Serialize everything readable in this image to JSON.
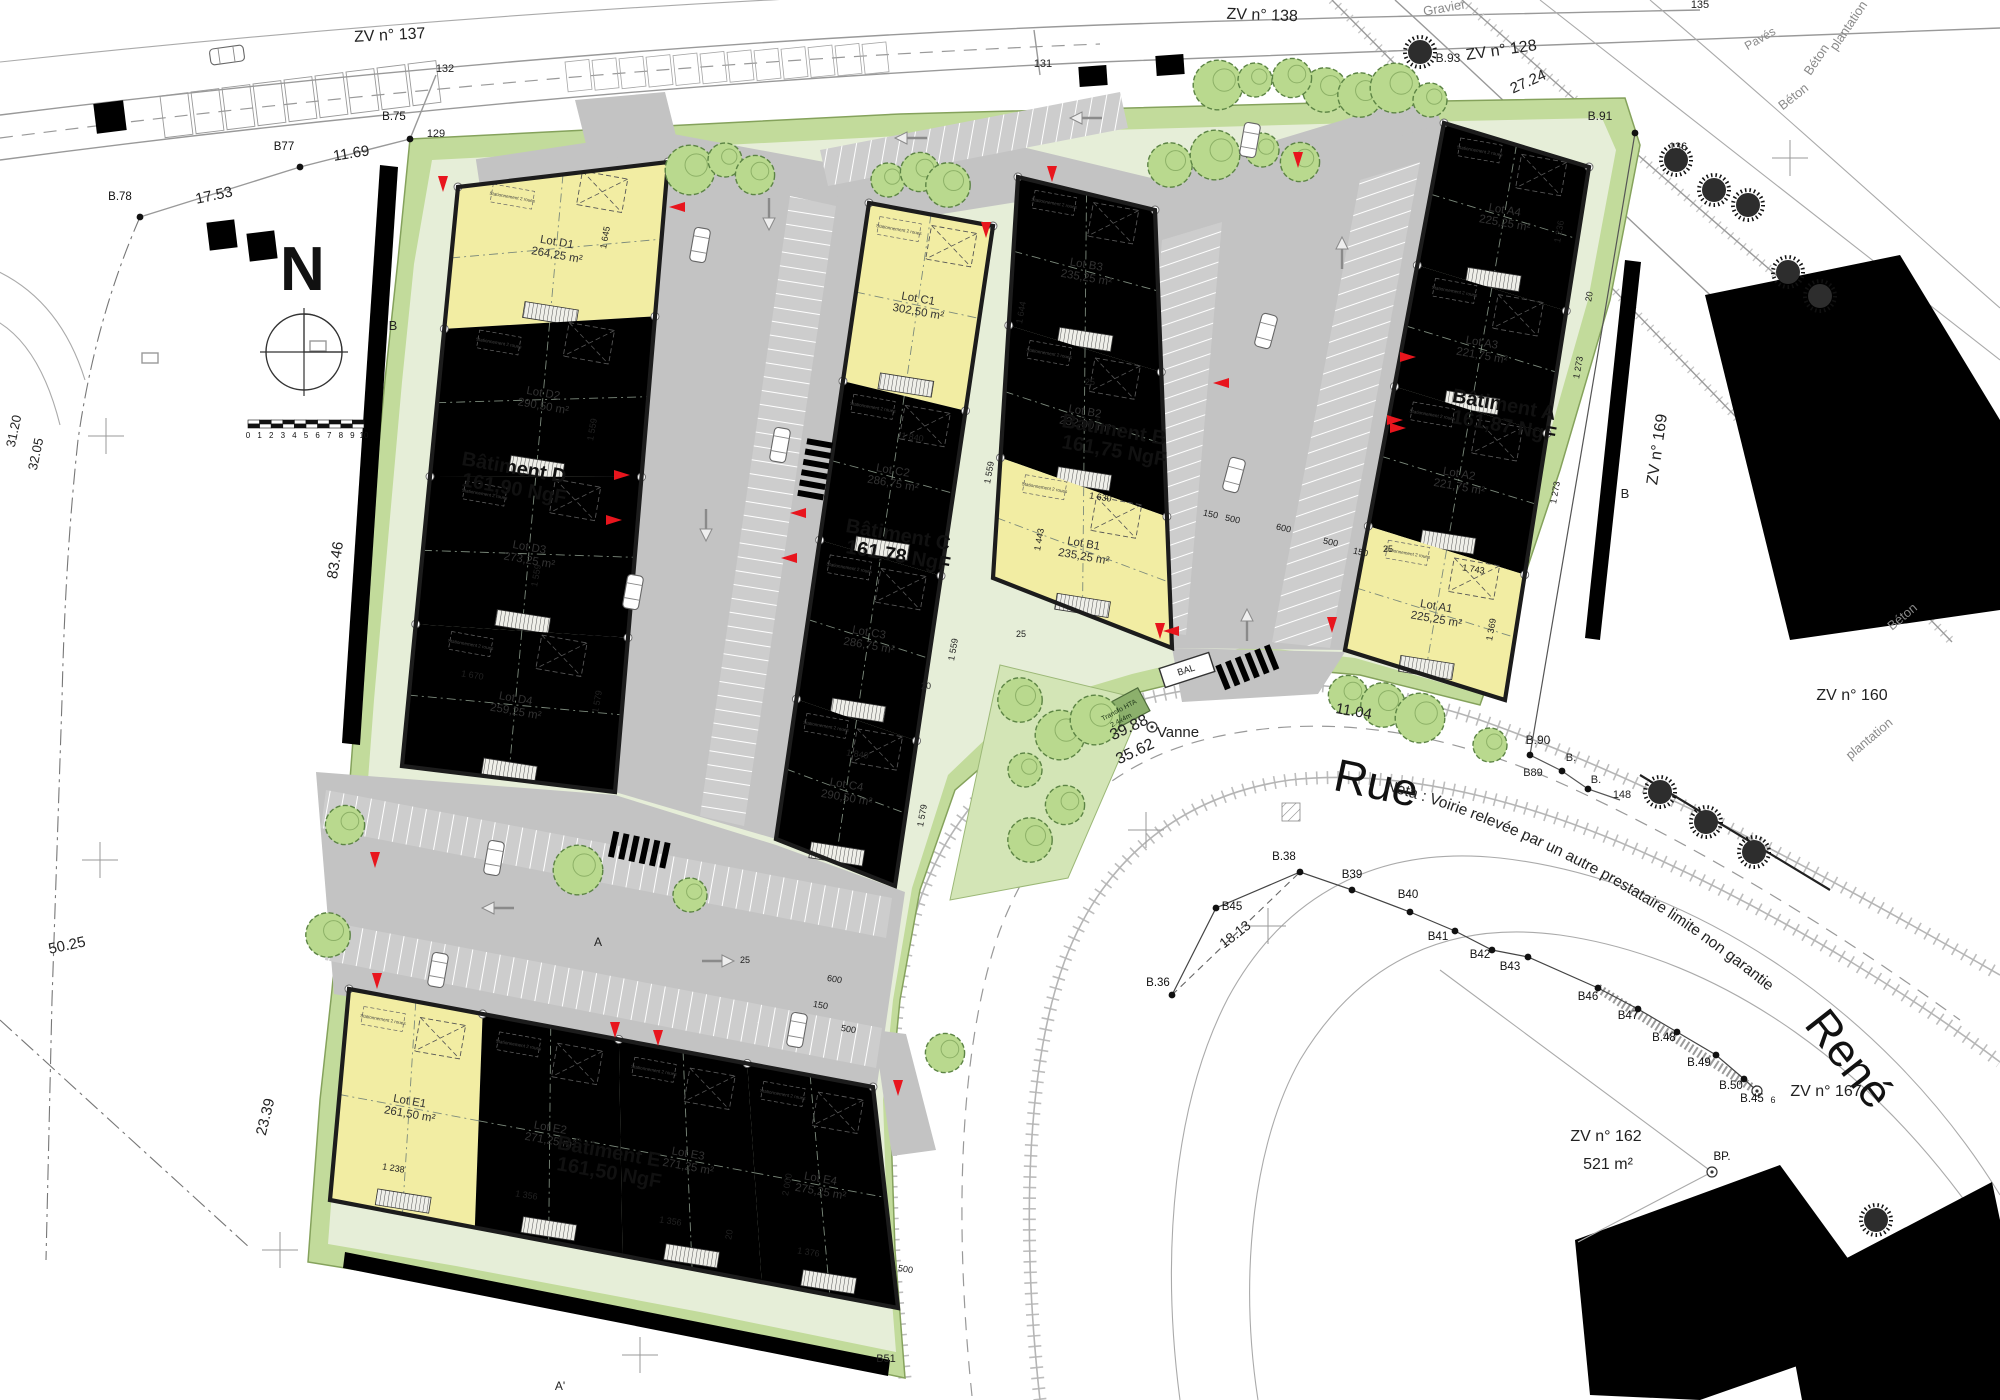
{
  "drawing": {
    "type": "plan de masse / site plan",
    "north_label": "N",
    "street": {
      "rue": "Rue",
      "rene": "René",
      "nota": "Nota : Voirie relevée par un autre prestataire limite non garantie"
    },
    "colors": {
      "lot_yellow": "#f2eda3",
      "lot_green": "#dce9a3",
      "lot_teal": "#8ce2c5",
      "lot_blue": "#a9c8e8",
      "road_gray": "#c3c3c3",
      "site_green": "#c2db9b",
      "marker_red": "#e8151d"
    },
    "bike_note": "Stationnement 2 roues",
    "scalebar_ticks": [
      "0",
      "1",
      "2",
      "3",
      "4",
      "5",
      "6",
      "7",
      "8",
      "9",
      "10"
    ]
  },
  "buildings": [
    {
      "name": "Bâtiment D",
      "ngf": "161,90 NgF",
      "dir": "v",
      "lp": [
        513,
        478
      ],
      "quad": [
        [
          458,
          187
        ],
        [
          668,
          162
        ],
        [
          615,
          792
        ],
        [
          402,
          766
        ]
      ],
      "lots": [
        {
          "id": "Lot D1",
          "area": "264,25 m²",
          "color": "yellow",
          "f": [
            0,
            0.245
          ]
        },
        {
          "id": "Lot D2",
          "area": "290,50 m²",
          "color": "green",
          "f": [
            0.245,
            0.5
          ]
        },
        {
          "id": "Lot D3",
          "area": "273,25 m²",
          "color": "teal",
          "f": [
            0.5,
            0.755
          ]
        },
        {
          "id": "Lot D4",
          "area": "259,25 m²",
          "color": "blue",
          "f": [
            0.755,
            1
          ]
        }
      ]
    },
    {
      "name": "Bâtiment C",
      "ngf": "161,78 NgF",
      "dir": "v",
      "lp": [
        897,
        545
      ],
      "quad": [
        [
          869,
          203
        ],
        [
          993,
          226
        ],
        [
          895,
          886
        ],
        [
          776,
          839
        ]
      ],
      "lots": [
        {
          "id": "Lot C1",
          "area": "302,50 m²",
          "color": "yellow",
          "f": [
            0,
            0.28
          ]
        },
        {
          "id": "Lot C2",
          "area": "286,75 m²",
          "color": "green",
          "f": [
            0.28,
            0.53
          ]
        },
        {
          "id": "Lot C3",
          "area": "286,75 m²",
          "color": "teal",
          "f": [
            0.53,
            0.78
          ]
        },
        {
          "id": "Lot C4",
          "area": "290,50 m²",
          "color": "blue",
          "f": [
            0.78,
            1
          ]
        }
      ]
    },
    {
      "name": "Bâtiment B",
      "ngf": "161,75 NgF",
      "dir": "v",
      "lp": [
        1113,
        440
      ],
      "quad": [
        [
          1018,
          177
        ],
        [
          1155,
          210
        ],
        [
          1172,
          648
        ],
        [
          993,
          578
        ]
      ],
      "lots": [
        {
          "id": "Lot B3",
          "area": "235,25 m²",
          "color": "teal",
          "f": [
            0,
            0.37
          ]
        },
        {
          "id": "Lot B2",
          "area": "232,00 m²",
          "color": "green",
          "f": [
            0.37,
            0.7
          ]
        },
        {
          "id": "Lot B1",
          "area": "235,25 m²",
          "color": "yellow",
          "f": [
            0.7,
            1
          ]
        }
      ]
    },
    {
      "name": "Bâtiment A",
      "ngf": "161,87 NgF",
      "dir": "v",
      "lp": [
        1503,
        415
      ],
      "quad": [
        [
          1444,
          123
        ],
        [
          1589,
          167
        ],
        [
          1505,
          700
        ],
        [
          1345,
          650
        ]
      ],
      "lots": [
        {
          "id": "Lot A4",
          "area": "225,25 m²",
          "color": "blue",
          "f": [
            0,
            0.27
          ]
        },
        {
          "id": "Lot A3",
          "area": "221,75 m²",
          "color": "teal",
          "f": [
            0.27,
            0.5
          ]
        },
        {
          "id": "Lot A2",
          "area": "221,75 m²",
          "color": "green",
          "f": [
            0.5,
            0.765
          ]
        },
        {
          "id": "Lot A1",
          "area": "225,25 m²",
          "color": "yellow",
          "f": [
            0.765,
            1
          ]
        }
      ]
    },
    {
      "name": "Bâtiment E",
      "ngf": "161,50 NgF",
      "dir": "h",
      "lp": [
        608,
        1162
      ],
      "quad": [
        [
          349,
          989
        ],
        [
          873,
          1087
        ],
        [
          898,
          1308
        ],
        [
          330,
          1200
        ]
      ],
      "lots": [
        {
          "id": "Lot E1",
          "area": "261,50 m²",
          "color": "yellow",
          "f": [
            0,
            0.255
          ]
        },
        {
          "id": "Lot E2",
          "area": "271,25 m²",
          "color": "green",
          "f": [
            0.255,
            0.515
          ]
        },
        {
          "id": "Lot E3",
          "area": "271,25 m²",
          "color": "teal",
          "f": [
            0.515,
            0.76
          ]
        },
        {
          "id": "Lot E4",
          "area": "275,25 m²",
          "color": "blue",
          "f": [
            0.76,
            1
          ]
        }
      ]
    }
  ],
  "dims": [
    [
      "1 645",
      608,
      238,
      -80
    ],
    [
      "1 559",
      595,
      430,
      -80
    ],
    [
      "1 559",
      539,
      576,
      -80
    ],
    [
      "1 670",
      472,
      678,
      9
    ],
    [
      "1 579",
      600,
      702,
      -80
    ],
    [
      "1 644",
      1024,
      313,
      -80
    ],
    [
      "1 840",
      912,
      440,
      9
    ],
    [
      "1 559",
      992,
      473,
      -80
    ],
    [
      "1 559",
      956,
      650,
      -80
    ],
    [
      "1 840",
      857,
      757,
      9
    ],
    [
      "1 579",
      925,
      816,
      -80
    ],
    [
      "1 630",
      1100,
      500,
      9
    ],
    [
      "1 443",
      1042,
      540,
      -80
    ],
    [
      "1 236",
      1562,
      232,
      -80
    ],
    [
      "1 273",
      1581,
      368,
      -80
    ],
    [
      "1 273",
      1558,
      493,
      -80
    ],
    [
      "1 743",
      1473,
      572,
      9
    ],
    [
      "1 369",
      1494,
      630,
      -80
    ],
    [
      "1 238",
      393,
      1171,
      9
    ],
    [
      "1 356",
      526,
      1198,
      9
    ],
    [
      "1 356",
      670,
      1224,
      9
    ],
    [
      "2 000",
      790,
      1185,
      -80
    ],
    [
      "1 376",
      808,
      1255,
      9
    ],
    [
      "150",
      1210,
      517,
      12
    ],
    [
      "500",
      1232,
      522,
      12
    ],
    [
      "600",
      1283,
      531,
      12
    ],
    [
      "500",
      1330,
      545,
      12
    ],
    [
      "150",
      1360,
      555,
      12
    ],
    [
      "600",
      834,
      982,
      10
    ],
    [
      "150",
      820,
      1008,
      10
    ],
    [
      "500",
      848,
      1032,
      10
    ],
    [
      "500",
      905,
      1272,
      10
    ],
    [
      "25",
      1021,
      637,
      0
    ],
    [
      "25",
      1090,
      385,
      0
    ],
    [
      "25",
      1388,
      552,
      0
    ],
    [
      "25",
      745,
      963,
      0
    ],
    [
      "20",
      1592,
      297,
      -80
    ],
    [
      "20",
      732,
      1235,
      -80
    ],
    [
      "20",
      926,
      689,
      0
    ]
  ],
  "misc": [
    [
      "Gravier",
      1445,
      12,
      -10,
      13,
      "g"
    ],
    [
      "Pavés",
      1762,
      42,
      -30,
      12,
      "g"
    ],
    [
      "ZV n° 137",
      390,
      40,
      -3,
      16
    ],
    [
      "ZV n° 138",
      1262,
      20,
      2,
      16
    ],
    [
      "ZV n° 128",
      1502,
      55,
      -8,
      16
    ],
    [
      "27.24",
      1530,
      86,
      -24,
      15
    ],
    [
      "135",
      1700,
      8,
      0,
      11
    ],
    [
      "131",
      1043,
      67,
      0,
      11
    ],
    [
      "132",
      445,
      72,
      0,
      11
    ],
    [
      "129",
      436,
      137,
      0,
      11
    ],
    [
      "11.69",
      352,
      158,
      -9,
      15
    ],
    [
      "17.53",
      215,
      200,
      -12,
      15
    ],
    [
      "31.20",
      18,
      432,
      -78,
      13
    ],
    [
      "32.05",
      40,
      455,
      -78,
      13
    ],
    [
      "83.46",
      340,
      561,
      -80,
      15
    ],
    [
      "50.25",
      68,
      950,
      -12,
      15
    ],
    [
      "23.39",
      270,
      1118,
      -76,
      15
    ],
    [
      "B",
      393,
      330,
      0,
      13
    ],
    [
      "B",
      1625,
      498,
      0,
      13
    ],
    [
      "A",
      598,
      946,
      0,
      12
    ],
    [
      "A'",
      560,
      1390,
      0,
      12
    ],
    [
      "B51",
      886,
      1362,
      0,
      11
    ],
    [
      "plantation",
      1852,
      28,
      -56,
      13,
      "g"
    ],
    [
      "Béton",
      1820,
      62,
      -56,
      13,
      "g"
    ],
    [
      "Béton",
      1796,
      100,
      -38,
      13,
      "g"
    ],
    [
      "Béton",
      1905,
      620,
      -40,
      13,
      "g"
    ],
    [
      "plantation",
      1872,
      742,
      -40,
      13,
      "g"
    ],
    [
      "ZV n° 169",
      1662,
      450,
      -82,
      16
    ],
    [
      "ZV n° 160",
      1852,
      700,
      0,
      16
    ],
    [
      "ZV n° 167",
      1826,
      1096,
      0,
      16
    ],
    [
      "ZV n° 162",
      1606,
      1141,
      0,
      16
    ],
    [
      "521 m²",
      1608,
      1169,
      0,
      16
    ],
    [
      "B.91",
      1600,
      120,
      0,
      12
    ],
    [
      "136",
      1678,
      150,
      0,
      11
    ],
    [
      "B.93",
      1448,
      62,
      0,
      12
    ],
    [
      "B.90",
      1538,
      744,
      0,
      12
    ],
    [
      "B.",
      1571,
      761,
      0,
      11
    ],
    [
      "B89",
      1533,
      776,
      0,
      11
    ],
    [
      "B.",
      1596,
      783,
      0,
      11
    ],
    [
      "148",
      1622,
      798,
      0,
      11
    ],
    [
      "11.04",
      1353,
      716,
      10,
      15
    ],
    [
      "Vanne",
      1178,
      737,
      0,
      15
    ],
    [
      "39.88",
      1131,
      732,
      -25,
      16
    ],
    [
      "35.62",
      1137,
      756,
      -25,
      16
    ],
    [
      "18.13",
      1238,
      938,
      -38,
      14
    ],
    [
      "6",
      1773,
      1103,
      0,
      9
    ],
    [
      "BAL",
      1187,
      673,
      -18,
      9.5
    ],
    [
      "Transfo HTA",
      1120,
      712,
      -28,
      7,
      "tr"
    ],
    [
      "2.4x4m",
      1122,
      722,
      -28,
      7,
      "tr"
    ]
  ],
  "points": [
    [
      "B.75",
      394,
      120,
      410,
      139,
      0
    ],
    [
      "B77",
      284,
      150,
      300,
      167,
      0
    ],
    [
      "B.78",
      120,
      200,
      140,
      217,
      0
    ],
    [
      "B.38",
      1284,
      860,
      1300,
      872,
      0
    ],
    [
      "B39",
      1352,
      878,
      1352,
      890,
      0
    ],
    [
      "B40",
      1408,
      898,
      1410,
      912,
      0
    ],
    [
      "B41",
      1438,
      940,
      1455,
      931,
      0
    ],
    [
      "B42",
      1480,
      958,
      1492,
      950,
      0
    ],
    [
      "B43",
      1510,
      970,
      1528,
      957,
      0
    ],
    [
      "B45",
      1232,
      910,
      1216,
      908,
      0
    ],
    [
      "B.36",
      1158,
      986,
      1172,
      995,
      0
    ],
    [
      "B46",
      1588,
      1000,
      1598,
      988,
      0
    ],
    [
      "B47",
      1628,
      1019,
      1638,
      1009,
      0
    ],
    [
      "B.48",
      1664,
      1041,
      1677,
      1032,
      0
    ],
    [
      "B.49",
      1699,
      1066,
      1716,
      1055,
      0
    ],
    [
      "B.50",
      1731,
      1089,
      1744,
      1079,
      0
    ],
    [
      "B.45",
      1752,
      1102,
      1757,
      1091,
      1
    ],
    [
      "",
      0,
      0,
      1152,
      727,
      1
    ],
    [
      "BP.",
      1722,
      1160,
      1712,
      1172,
      1
    ],
    [
      "",
      0,
      0,
      1530,
      755,
      0
    ],
    [
      "",
      0,
      0,
      1562,
      771,
      0
    ],
    [
      "",
      0,
      0,
      1588,
      789,
      0
    ],
    [
      "",
      0,
      0,
      1635,
      133,
      0
    ]
  ],
  "reds": [
    [
      1052,
      174,
      90
    ],
    [
      986,
      230,
      90
    ],
    [
      1298,
      160,
      90
    ],
    [
      1221,
      383,
      180
    ],
    [
      1398,
      428,
      0
    ],
    [
      677,
      207,
      180
    ],
    [
      622,
      475,
      0
    ],
    [
      614,
      520,
      0
    ],
    [
      798,
      513,
      180
    ],
    [
      789,
      558,
      180
    ],
    [
      443,
      184,
      90
    ],
    [
      1408,
      357,
      0
    ],
    [
      1395,
      420,
      0
    ],
    [
      375,
      860,
      90
    ],
    [
      615,
      1030,
      90
    ],
    [
      658,
      1038,
      90
    ],
    [
      377,
      981,
      90
    ],
    [
      1171,
      631,
      180
    ],
    [
      1332,
      625,
      90
    ],
    [
      1160,
      631,
      90
    ],
    [
      898,
      1088,
      90
    ]
  ],
  "trees_light": [
    [
      888,
      180
    ],
    [
      920,
      172
    ],
    [
      948,
      185
    ],
    [
      690,
      170
    ],
    [
      725,
      160
    ],
    [
      755,
      175
    ],
    [
      1170,
      165
    ],
    [
      1215,
      155
    ],
    [
      1262,
      150
    ],
    [
      1300,
      162
    ],
    [
      1325,
      90
    ],
    [
      1218,
      85
    ],
    [
      1255,
      80
    ],
    [
      1292,
      78
    ],
    [
      1360,
      95
    ],
    [
      1395,
      88
    ],
    [
      1430,
      100
    ],
    [
      345,
      825
    ],
    [
      328,
      935
    ],
    [
      578,
      870
    ],
    [
      690,
      895
    ],
    [
      1348,
      695
    ],
    [
      1383,
      705
    ],
    [
      1420,
      718
    ],
    [
      1490,
      745
    ],
    [
      945,
      1053
    ],
    [
      1020,
      700
    ],
    [
      1060,
      735
    ],
    [
      1025,
      770
    ],
    [
      1065,
      805
    ],
    [
      1030,
      840
    ],
    [
      1095,
      720
    ]
  ],
  "trees_dark": [
    [
      1420,
      52
    ],
    [
      1676,
      160
    ],
    [
      1714,
      190
    ],
    [
      1748,
      205
    ],
    [
      1788,
      272
    ],
    [
      1820,
      296
    ],
    [
      1660,
      792
    ],
    [
      1706,
      822
    ],
    [
      1754,
      852
    ],
    [
      1876,
      1220
    ]
  ],
  "cars": [
    [
      700,
      245,
      100
    ],
    [
      780,
      445,
      100
    ],
    [
      633,
      592,
      100
    ],
    [
      494,
      858,
      100
    ],
    [
      438,
      970,
      100
    ],
    [
      797,
      1030,
      100
    ],
    [
      1266,
      331,
      -75
    ],
    [
      1234,
      475,
      -75
    ],
    [
      1250,
      140,
      -80
    ],
    [
      227,
      55,
      -8
    ]
  ],
  "arrows": [
    [
      1088,
      118,
      180
    ],
    [
      913,
      138,
      180
    ],
    [
      769,
      212,
      90
    ],
    [
      706,
      523,
      90
    ],
    [
      1342,
      255,
      -90
    ],
    [
      1247,
      627,
      -90
    ],
    [
      716,
      961,
      0
    ],
    [
      500,
      908,
      180
    ]
  ],
  "crosses": [
    [
      106,
      436
    ],
    [
      100,
      860
    ],
    [
      280,
      1250
    ],
    [
      640,
      1355
    ],
    [
      1268,
      926
    ],
    [
      1146,
      830
    ],
    [
      1790,
      158
    ]
  ],
  "crosswalks": [
    [
      640,
      850,
      12
    ],
    [
      1248,
      667,
      -22
    ],
    [
      815,
      470,
      100
    ]
  ]
}
